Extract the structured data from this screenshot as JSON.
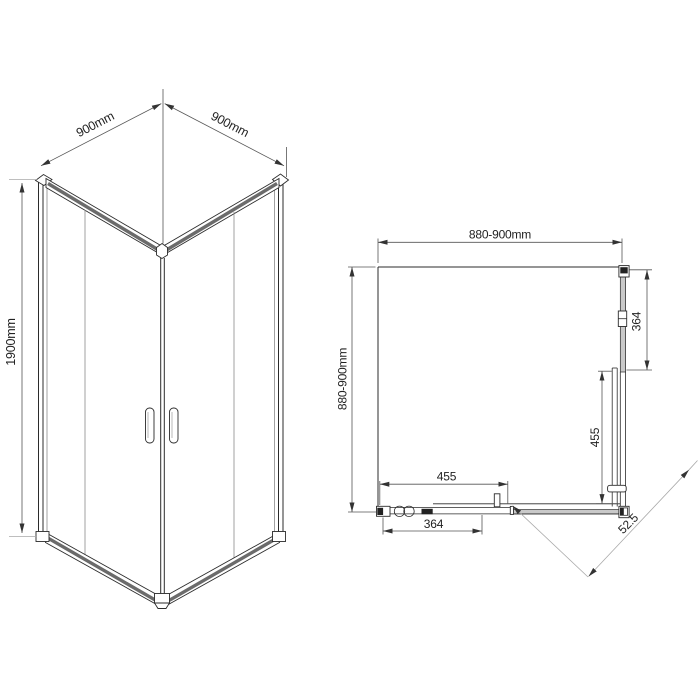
{
  "isometric_view": {
    "dim_top_left": "900mm",
    "dim_top_right": "900mm",
    "dim_height": "1900mm"
  },
  "plan_view": {
    "dim_width_top": "880-900mm",
    "dim_depth_left": "880-900mm",
    "dim_side_panel_right": "364",
    "dim_door_right": "455",
    "dim_door_bottom": "455",
    "dim_side_panel_bottom": "364",
    "dim_diagonal_entry": "52.5"
  },
  "colors": {
    "line": "#2b2b2b",
    "dimension": "#555555",
    "light_line": "#a9a9a9",
    "profile_stripe": "#6b6b6b",
    "panel_fill": "#c9c9c9",
    "background": "#ffffff"
  }
}
